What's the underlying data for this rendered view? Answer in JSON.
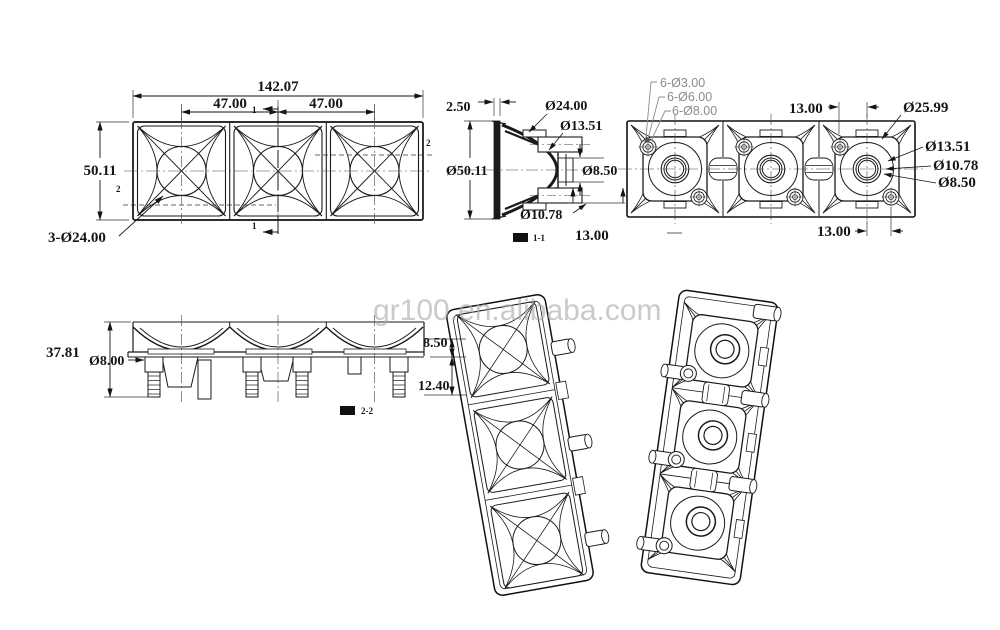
{
  "watermark": {
    "text": "gr100.en.alibaba.com"
  },
  "front_view": {
    "dim_total_width": "142.07",
    "dim_pitch_left": "47.00",
    "dim_pitch_right": "47.00",
    "dim_height": "50.11",
    "dim_lens_circles": "3-Ø24.00",
    "section_marker_1": "1",
    "section_marker_2": "2"
  },
  "section_view": {
    "dim_wall": "2.50",
    "dim_outer_ring": "Ø24.00",
    "dim_inner_ring": "Ø13.51",
    "dim_overall": "Ø50.11",
    "dim_bore": "Ø8.50",
    "dim_pin_hole": "Ø10.78",
    "label": "1-1"
  },
  "back_view": {
    "callout_holes_small": "6-Ø3.00",
    "callout_holes_mid": "6-Ø6.00",
    "callout_holes_large": "6-Ø8.00",
    "dim_offset_top": "13.00",
    "dim_ring_outer": "Ø25.99",
    "dim_ring_13": "Ø13.51",
    "dim_ring_10": "Ø10.78",
    "dim_ring_8": "Ø8.50",
    "dim_offset_bottom": "13.00",
    "dim_offset_left": "13.00"
  },
  "side_view": {
    "dim_height": "37.81",
    "dim_pin_dia": "Ø8.00",
    "dim_step_upper": "8.50",
    "dim_step_lower": "12.40",
    "label": "2-2"
  }
}
